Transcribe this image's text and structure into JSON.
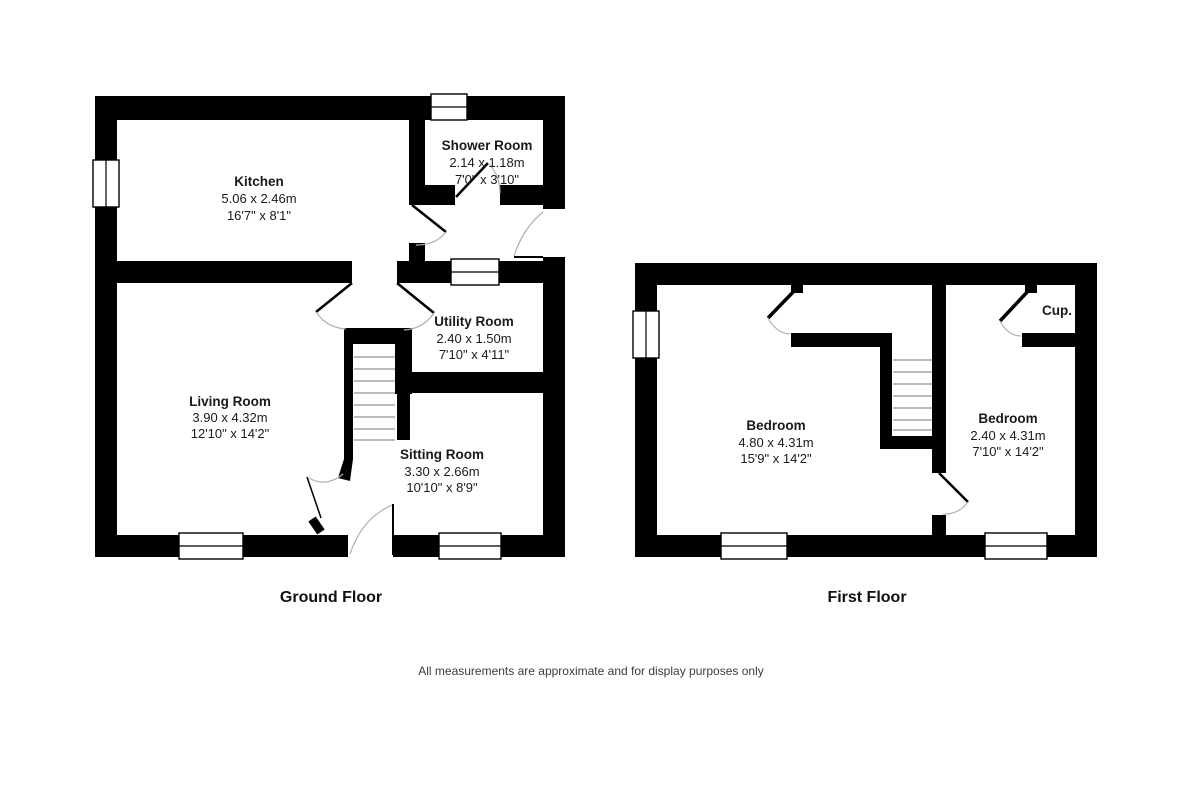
{
  "colors": {
    "wall": "#000000",
    "background": "#ffffff",
    "text": "#1a1a1a",
    "door_arc": "#b0b0b0",
    "stair_tread": "#7a7a7a",
    "disclaimer_text": "#3c3c3c"
  },
  "ground_floor": {
    "title": "Ground Floor",
    "rooms": [
      {
        "name": "Kitchen",
        "metric": "5.06 x 2.46m",
        "imperial": "16'7\" x 8'1\""
      },
      {
        "name": "Shower Room",
        "metric": "2.14 x 1.18m",
        "imperial": "7'0\" x 3'10\""
      },
      {
        "name": "Utility Room",
        "metric": "2.40 x 1.50m",
        "imperial": "7'10\" x 4'11\""
      },
      {
        "name": "Living Room",
        "metric": "3.90 x 4.32m",
        "imperial": "12'10\" x 14'2\""
      },
      {
        "name": "Sitting Room",
        "metric": "3.30 x 2.66m",
        "imperial": "10'10\" x 8'9\""
      }
    ]
  },
  "first_floor": {
    "title": "First Floor",
    "cupboard_label": "Cup.",
    "rooms": [
      {
        "name": "Bedroom",
        "metric": "4.80 x 4.31m",
        "imperial": "15'9\" x 14'2\""
      },
      {
        "name": "Bedroom",
        "metric": "2.40 x 4.31m",
        "imperial": "7'10\" x 14'2\""
      }
    ]
  },
  "footer": {
    "disclaimer": "All measurements are approximate and for display purposes only"
  }
}
